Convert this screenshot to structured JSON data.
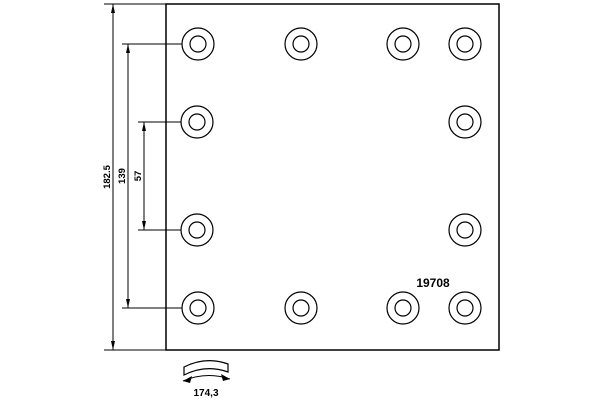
{
  "drawing": {
    "part_number": "19708",
    "dimensions": {
      "overall_width": "182.5",
      "hole_span": "139",
      "hole_pitch": "57",
      "arc_width": "174,3"
    },
    "holes": {
      "outer_radius": 16,
      "inner_radius": 8,
      "rows": [
        {
          "y": 44,
          "x": [
            198,
            301,
            403,
            465
          ]
        },
        {
          "y": 122,
          "x": [
            197,
            465
          ]
        },
        {
          "y": 230,
          "x": [
            197,
            465
          ]
        },
        {
          "y": 308,
          "x": [
            198,
            301,
            403,
            465
          ]
        }
      ]
    },
    "colors": {
      "line": "#000000",
      "background": "#ffffff"
    }
  }
}
